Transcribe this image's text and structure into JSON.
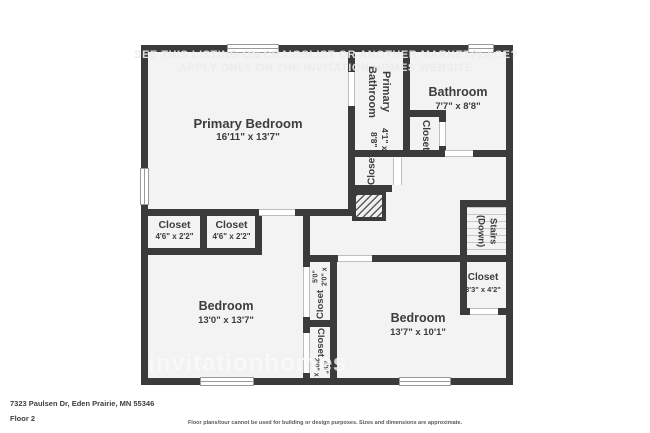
{
  "colors": {
    "wall": "#3b3b3b",
    "floor": "#f3f3f3",
    "page": "#ffffff",
    "label_text": "#3d3d3d"
  },
  "watermark": {
    "line1": "SEE THIS LISTING ON CRAIGSLIST OR ANOTHER MARKETPLACE?",
    "line2": "APPLY ONLY ON THE INVITATION HOMES WEBSITE",
    "brand": "invitationhomes"
  },
  "rooms": {
    "primary_bedroom": {
      "name": "Primary Bedroom",
      "dims": "16'11\" x 13'7\""
    },
    "primary_bathroom": {
      "name": "Primary Bathroom",
      "dims": "4'1\" x 8'8\""
    },
    "bathroom": {
      "name": "Bathroom",
      "dims": "7'7\" x 8'8\""
    },
    "bathroom_closet": {
      "name": "Closet"
    },
    "hall_closet": {
      "name": "Closet"
    },
    "stairs": {
      "name": "Stairs (Down)"
    },
    "right_closet": {
      "name": "Closet",
      "dims": "3'3\" x 4'2\""
    },
    "closet_a": {
      "name": "Closet",
      "dims": "4'6\" x 2'2\""
    },
    "closet_b": {
      "name": "Closet",
      "dims": "4'6\" x 2'2\""
    },
    "bedroom_left": {
      "name": "Bedroom",
      "dims": "13'0\" x 13'7\""
    },
    "bedroom_right": {
      "name": "Bedroom",
      "dims": "13'7\" x 10'1\""
    },
    "closet_tall_upper": {
      "name": "Closet",
      "dims": "2'0\" x 5'0\""
    },
    "closet_tall_lower": {
      "name": "Closet",
      "dims": "2'0\" x 4'9\""
    }
  },
  "footer": {
    "address": "7323 Paulsen Dr, Eden Prairie, MN 55346",
    "floor": "Floor 2",
    "disclaimer": "Floor plans/tour cannot be used for building or design purposes. Sizes and dimensions are approximate."
  }
}
